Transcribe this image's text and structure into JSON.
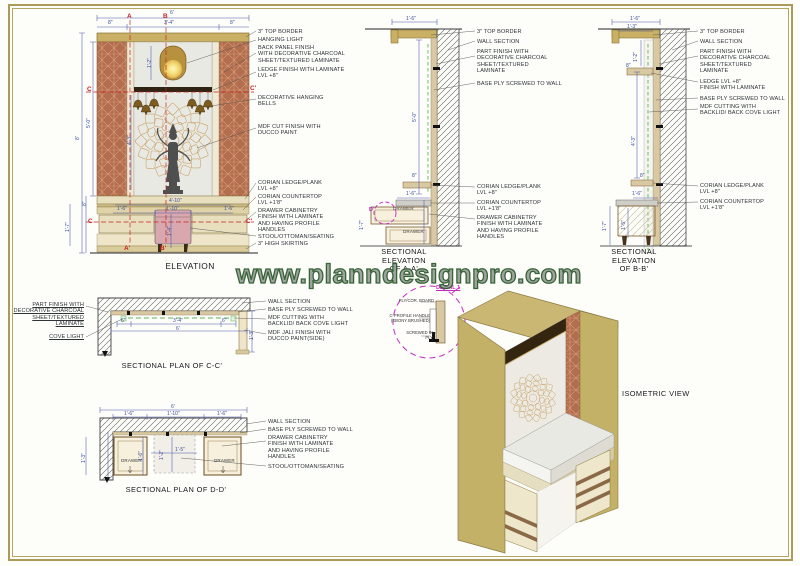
{
  "watermark": "www.planndesignpro.com",
  "colors": {
    "border": "#ac9b58",
    "dim_blue": "#3c4da0",
    "marker_red": "#c42222",
    "detail_magenta": "#c42ac4",
    "cove_green": "#5bb65b",
    "copper": "#b06a4a",
    "tan": "#c9b064",
    "stool_pink": "#d8a8ae"
  },
  "labels": [
    {
      "n": "elevation-title",
      "t": "ELEVATION",
      "x": 190,
      "y": 262,
      "cls": "t tl",
      "a": "c"
    },
    {
      "n": "section-aa-title",
      "t": "SECTIONAL\nELEVATION\nOF A-A'",
      "x": 404,
      "y": 248,
      "cls": "t",
      "a": "c"
    },
    {
      "n": "section-bb-title",
      "t": "SECTIONAL\nELEVATION\nOF B-B'",
      "x": 634,
      "y": 248,
      "cls": "t",
      "a": "c"
    },
    {
      "n": "plan-cc-title",
      "t": "SECTIONAL PLAN OF C-C'",
      "x": 172,
      "y": 362,
      "cls": "t",
      "a": "c"
    },
    {
      "n": "plan-dd-title",
      "t": "SECTIONAL PLAN OF D-D'",
      "x": 176,
      "y": 486,
      "cls": "t",
      "a": "c"
    },
    {
      "n": "isometric-title",
      "t": "ISOMETRIC VIEW",
      "x": 622,
      "y": 390,
      "cls": "t"
    },
    {
      "n": "detail-title",
      "t": "DETAIL 1",
      "x": 436,
      "y": 285,
      "cls": "mm u"
    },
    {
      "n": "callout",
      "t": "3\" TOP BORDER",
      "x": 258,
      "y": 29
    },
    {
      "n": "callout",
      "t": "HANGING LIGHT",
      "x": 258,
      "y": 37
    },
    {
      "n": "callout",
      "t": "BACK PANEL FINISH\nWITH DECORATIVE CHARCOAL\nSHEET/TEXTURED LAMINATE",
      "x": 258,
      "y": 45
    },
    {
      "n": "callout",
      "t": "LEDGE FINISH WITH LAMINATE\nLVL +8\"",
      "x": 258,
      "y": 67
    },
    {
      "n": "callout",
      "t": "DECORATIVE HANGING\nBELLS",
      "x": 258,
      "y": 95
    },
    {
      "n": "callout",
      "t": "MDF CUT FINISH WITH\nDUCCO PAINT",
      "x": 258,
      "y": 124
    },
    {
      "n": "callout",
      "t": "CORIAN LEDGE/PLANK\nLVL +8\"",
      "x": 258,
      "y": 180
    },
    {
      "n": "callout",
      "t": "CORIAN COUNTERTOP\nLVL +1'8\"",
      "x": 258,
      "y": 194
    },
    {
      "n": "callout",
      "t": "DRAWER CABINETRY\nFINISH WITH LAMINATE\nAND HAVING PROFILE\nHANDLES",
      "x": 258,
      "y": 208
    },
    {
      "n": "callout",
      "t": "STOOL/OTTOMAN/SEATING",
      "x": 258,
      "y": 234
    },
    {
      "n": "callout",
      "t": "3\" HIGH SKIRTING",
      "x": 258,
      "y": 241
    },
    {
      "n": "callout",
      "t": "3\" TOP BORDER",
      "x": 477,
      "y": 29
    },
    {
      "n": "callout",
      "t": "WALL SECTION",
      "x": 477,
      "y": 39
    },
    {
      "n": "callout",
      "t": "PART FINISH WITH\nDECORATIVE CHARCOAL\nSHEET/TEXTURED\nLAMINATE",
      "x": 477,
      "y": 49
    },
    {
      "n": "callout",
      "t": "BASE PLY SCREWED TO WALL",
      "x": 477,
      "y": 81
    },
    {
      "n": "callout",
      "t": "CORIAN LEDGE/PLANK\nLVL +8\"",
      "x": 477,
      "y": 184
    },
    {
      "n": "callout",
      "t": "CORIAN COUNTERTOP\nLVL +1'8\"",
      "x": 477,
      "y": 200
    },
    {
      "n": "callout",
      "t": "DRAWER CABINETRY\nFINISH WITH LAMINATE\nAND HAVING PROFILE\nHANDLES",
      "x": 477,
      "y": 215
    },
    {
      "n": "callout",
      "t": "3\" TOP BORDER",
      "x": 700,
      "y": 29
    },
    {
      "n": "callout",
      "t": "WALL SECTION",
      "x": 700,
      "y": 39
    },
    {
      "n": "callout",
      "t": "PART FINISH WITH\nDECORATIVE CHARCOAL\nSHEET/TEXTURED\nLAMINATE",
      "x": 700,
      "y": 49
    },
    {
      "n": "callout",
      "t": "LEDGE LVL +8\"\nFINISH WITH LAMINATE",
      "x": 700,
      "y": 79
    },
    {
      "n": "callout",
      "t": "BASE PLY SCREWED TO WALL",
      "x": 700,
      "y": 96
    },
    {
      "n": "callout",
      "t": "MDF CUTTING WITH\nBACKLID/ BACK COVE LIGHT",
      "x": 700,
      "y": 104
    },
    {
      "n": "callout",
      "t": "CORIAN LEDGE/PLANK\nLVL +8\"",
      "x": 700,
      "y": 183
    },
    {
      "n": "callout",
      "t": "CORIAN COUNTERTOP\nLVL +1'8\"",
      "x": 700,
      "y": 199
    },
    {
      "n": "callout",
      "t": "PART FINISH WITH\nDECORATIVE CHARCOAL\nSHEET/TEXTURED\nLAMINATE",
      "x": 84,
      "y": 302,
      "cls": "u",
      "a": "r"
    },
    {
      "n": "callout",
      "t": "COVE LIGHT",
      "x": 84,
      "y": 334,
      "cls": "u",
      "a": "r"
    },
    {
      "n": "callout",
      "t": "WALL SECTION",
      "x": 268,
      "y": 299
    },
    {
      "n": "callout",
      "t": "BASE PLY SCREWED TO WALL",
      "x": 268,
      "y": 307
    },
    {
      "n": "callout",
      "t": "MDF CUTTING WITH\nBACKLID/ BACK COVE LIGHT",
      "x": 268,
      "y": 315
    },
    {
      "n": "callout",
      "t": "MDF JALI FINISH WITH\nDUCCO PAINT(SIDE)",
      "x": 268,
      "y": 330
    },
    {
      "n": "callout",
      "t": "WALL SECTION",
      "x": 268,
      "y": 419
    },
    {
      "n": "callout",
      "t": "BASE PLY SCREWED TO WALL",
      "x": 268,
      "y": 427
    },
    {
      "n": "callout",
      "t": "DRAWER CABINETRY\nFINISH WITH LAMINATE\nAND HAVING PROFILE\nHANDLES",
      "x": 268,
      "y": 435
    },
    {
      "n": "callout",
      "t": "STOOL/OTTOMAN/SEATING",
      "x": 268,
      "y": 464
    },
    {
      "n": "detail-label",
      "t": "PLY/COR. BOARD",
      "x": 434,
      "y": 299,
      "cls": "dt",
      "a": "r"
    },
    {
      "n": "detail-label",
      "t": "C-PROFILE HANDLE\n(EBONY BRUSHED)",
      "x": 430,
      "y": 314,
      "cls": "dt",
      "a": "r"
    },
    {
      "n": "detail-label",
      "t": "SCREWED IN\nPLY",
      "x": 433,
      "y": 331,
      "cls": "dt",
      "a": "r"
    },
    {
      "n": "drawer-label",
      "t": "DRAWER",
      "x": 393,
      "y": 206,
      "cls": "dr"
    },
    {
      "n": "drawer-label",
      "t": "DRAWER",
      "x": 403,
      "y": 229,
      "cls": "dr"
    },
    {
      "n": "drawer-label",
      "t": "DRAWER",
      "x": 121,
      "y": 458,
      "cls": "dr"
    },
    {
      "n": "drawer-label",
      "t": "DRAWER",
      "x": 214,
      "y": 458,
      "cls": "dr"
    },
    {
      "n": "marker",
      "t": "A",
      "x": 127,
      "y": 13,
      "cls": "m"
    },
    {
      "n": "marker",
      "t": "B",
      "x": 163,
      "y": 13,
      "cls": "m"
    },
    {
      "n": "marker",
      "t": "A'",
      "x": 124,
      "y": 245,
      "cls": "m"
    },
    {
      "n": "marker",
      "t": "B'",
      "x": 160,
      "y": 245,
      "cls": "m"
    },
    {
      "n": "marker",
      "t": "C",
      "x": 87,
      "y": 86,
      "cls": "m"
    },
    {
      "n": "marker",
      "t": "C'",
      "x": 250,
      "y": 85,
      "cls": "m"
    },
    {
      "n": "marker",
      "t": "C",
      "x": 88,
      "y": 218,
      "cls": "m"
    },
    {
      "n": "marker",
      "t": "C'",
      "x": 246,
      "y": 218,
      "cls": "m"
    },
    {
      "n": "marker",
      "t": "D'",
      "x": 369,
      "y": 207,
      "cls": "mm"
    },
    {
      "n": "dim",
      "t": "6'",
      "x": 170,
      "y": 11,
      "cls": "d"
    },
    {
      "n": "dim",
      "t": "8\"",
      "x": 108,
      "y": 21,
      "cls": "d"
    },
    {
      "n": "dim",
      "t": "3'-4\"",
      "x": 164,
      "y": 21,
      "cls": "d"
    },
    {
      "n": "dim",
      "t": "8\"",
      "x": 230,
      "y": 21,
      "cls": "d"
    },
    {
      "n": "dim",
      "t": "8'",
      "x": 76,
      "y": 140,
      "cls": "d",
      "r": -90
    },
    {
      "n": "dim",
      "t": "5'-0\"",
      "x": 87,
      "y": 128,
      "cls": "d",
      "r": -90
    },
    {
      "n": "dim",
      "t": "1'-2\"",
      "x": 148,
      "y": 68,
      "cls": "d",
      "r": -90
    },
    {
      "n": "dim",
      "t": "4'-3\"",
      "x": 128,
      "y": 145,
      "cls": "d",
      "r": -90
    },
    {
      "n": "dim",
      "t": "8\"",
      "x": 83,
      "y": 206,
      "cls": "d",
      "r": -90
    },
    {
      "n": "dim",
      "t": "1'-7\"",
      "x": 66,
      "y": 232,
      "cls": "d",
      "r": -90
    },
    {
      "n": "dim",
      "t": "4'-10\"",
      "x": 169,
      "y": 199,
      "cls": "d"
    },
    {
      "n": "dim",
      "t": "1'-6\"",
      "x": 117,
      "y": 207,
      "cls": "d"
    },
    {
      "n": "dim",
      "t": "1'-10\"",
      "x": 166,
      "y": 207,
      "cls": "d"
    },
    {
      "n": "dim",
      "t": "1'-6\"",
      "x": 224,
      "y": 207,
      "cls": "d"
    },
    {
      "n": "dim",
      "t": "1'-4\"",
      "x": 168,
      "y": 236,
      "cls": "d",
      "r": -90
    },
    {
      "n": "dim",
      "t": "1'-6\"",
      "x": 406,
      "y": 17,
      "cls": "d"
    },
    {
      "n": "dim",
      "t": "5'-0\"",
      "x": 413,
      "y": 122,
      "cls": "d",
      "r": -90
    },
    {
      "n": "dim",
      "t": "8\"",
      "x": 412,
      "y": 174,
      "cls": "d"
    },
    {
      "n": "dim",
      "t": "1'-6\"",
      "x": 406,
      "y": 192,
      "cls": "d"
    },
    {
      "n": "dim",
      "t": "1'-7\"",
      "x": 360,
      "y": 230,
      "cls": "d",
      "r": -90
    },
    {
      "n": "dim",
      "t": "1'-6\"",
      "x": 630,
      "y": 17,
      "cls": "d"
    },
    {
      "n": "dim",
      "t": "1'-3\"",
      "x": 627,
      "y": 25,
      "cls": "d"
    },
    {
      "n": "dim",
      "t": "1'-2\"",
      "x": 634,
      "y": 62,
      "cls": "d",
      "r": -90
    },
    {
      "n": "dim",
      "t": "8\"",
      "x": 626,
      "y": 64,
      "cls": "d"
    },
    {
      "n": "dim",
      "t": "4'-3\"",
      "x": 632,
      "y": 146,
      "cls": "d",
      "r": -90
    },
    {
      "n": "dim",
      "t": "8\"",
      "x": 640,
      "y": 174,
      "cls": "d"
    },
    {
      "n": "dim",
      "t": "1'-6\"",
      "x": 632,
      "y": 192,
      "cls": "d"
    },
    {
      "n": "dim",
      "t": "1'-7\"",
      "x": 603,
      "y": 231,
      "cls": "d",
      "r": -90
    },
    {
      "n": "dim",
      "t": "1'-5\"",
      "x": 622,
      "y": 230,
      "cls": "d",
      "r": -90
    },
    {
      "n": "dim",
      "t": "6\"",
      "x": 121,
      "y": 319,
      "cls": "d"
    },
    {
      "n": "dim",
      "t": "3'-4\"",
      "x": 173,
      "y": 319,
      "cls": "d"
    },
    {
      "n": "dim",
      "t": "6\"",
      "x": 222,
      "y": 319,
      "cls": "d"
    },
    {
      "n": "dim",
      "t": "6'",
      "x": 176,
      "y": 327,
      "cls": "d"
    },
    {
      "n": "dim",
      "t": "1'-3\"",
      "x": 250,
      "y": 340,
      "cls": "d",
      "r": -90
    },
    {
      "n": "dim",
      "t": "6'",
      "x": 171,
      "y": 405,
      "cls": "d"
    },
    {
      "n": "dim",
      "t": "1'-6\"",
      "x": 124,
      "y": 412,
      "cls": "d"
    },
    {
      "n": "dim",
      "t": "1'-10\"",
      "x": 167,
      "y": 412,
      "cls": "d"
    },
    {
      "n": "dim",
      "t": "1'-6\"",
      "x": 217,
      "y": 412,
      "cls": "d"
    },
    {
      "n": "dim",
      "t": "1'-3\"",
      "x": 82,
      "y": 463,
      "cls": "d",
      "r": -90
    },
    {
      "n": "dim",
      "t": "1'-6\"",
      "x": 139,
      "y": 461,
      "cls": "d",
      "r": -90
    },
    {
      "n": "dim",
      "t": "1'-2\"",
      "x": 160,
      "y": 460,
      "cls": "d",
      "r": -90
    },
    {
      "n": "dim",
      "t": "1'-5\"",
      "x": 175,
      "y": 448,
      "cls": "d"
    }
  ]
}
